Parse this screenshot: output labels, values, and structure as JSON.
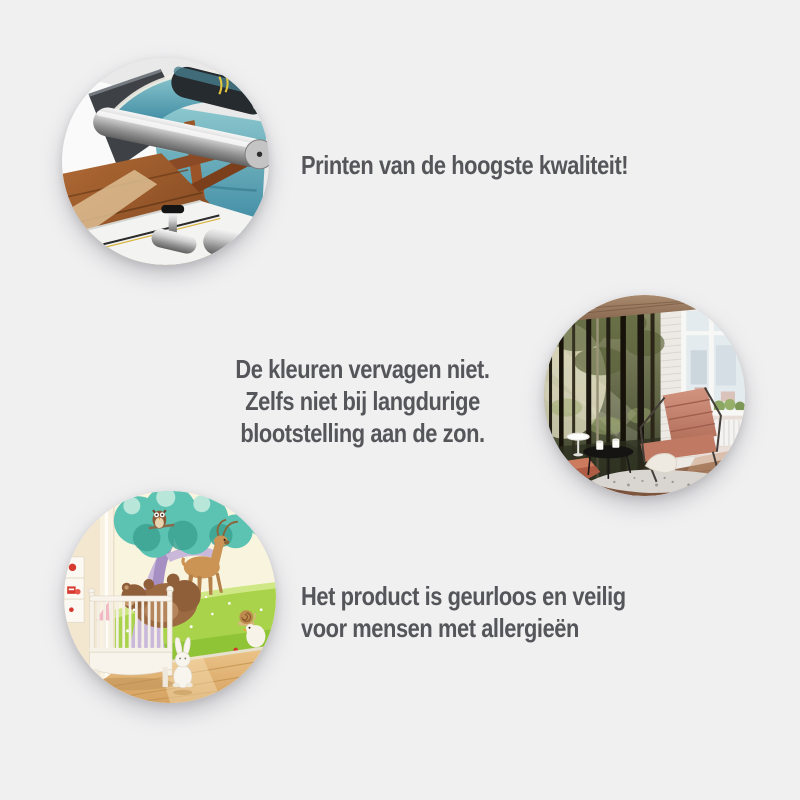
{
  "canvas": {
    "background_color": "#f0f0f1",
    "text_color": "#55565a",
    "width": 800,
    "height": 800
  },
  "features": [
    {
      "id": "print-quality",
      "photo": "large-format-printer-printing-wall-mural",
      "photo_palette": {
        "machine_dark": "#3e4247",
        "roller_silver": "#c9c9c9",
        "print_sea_teal": "#3a87a0",
        "print_wood_brown": "#a96535"
      },
      "lines": [
        "Printen van de hoogste kwaliteit!"
      ]
    },
    {
      "id": "colors-do-not-fade",
      "photo": "living-room-with-forest-wall-mural-and-window",
      "photo_palette": {
        "forest_green": "#5d6244",
        "brick_white": "#edeae5",
        "armchair_salmon": "#c27b65",
        "floor_brown": "#8d6a50"
      },
      "lines": [
        "De kleuren vervagen niet.",
        "Zelfs niet bij langdurige",
        "blootstelling aan de zon."
      ]
    },
    {
      "id": "odorless-allergy-safe",
      "photo": "nursery-with-cartoon-forest-animals-wall-mural",
      "photo_palette": {
        "meadow_green": "#a9d34b",
        "foliage_teal": "#5cc3b3",
        "trunk_lavender": "#c9b8da",
        "crib_white": "#f8f4ec",
        "floor_light_wood": "#e2b97c"
      },
      "lines": [
        "Het product is geurloos en veilig",
        "voor mensen met allergieën"
      ]
    }
  ]
}
